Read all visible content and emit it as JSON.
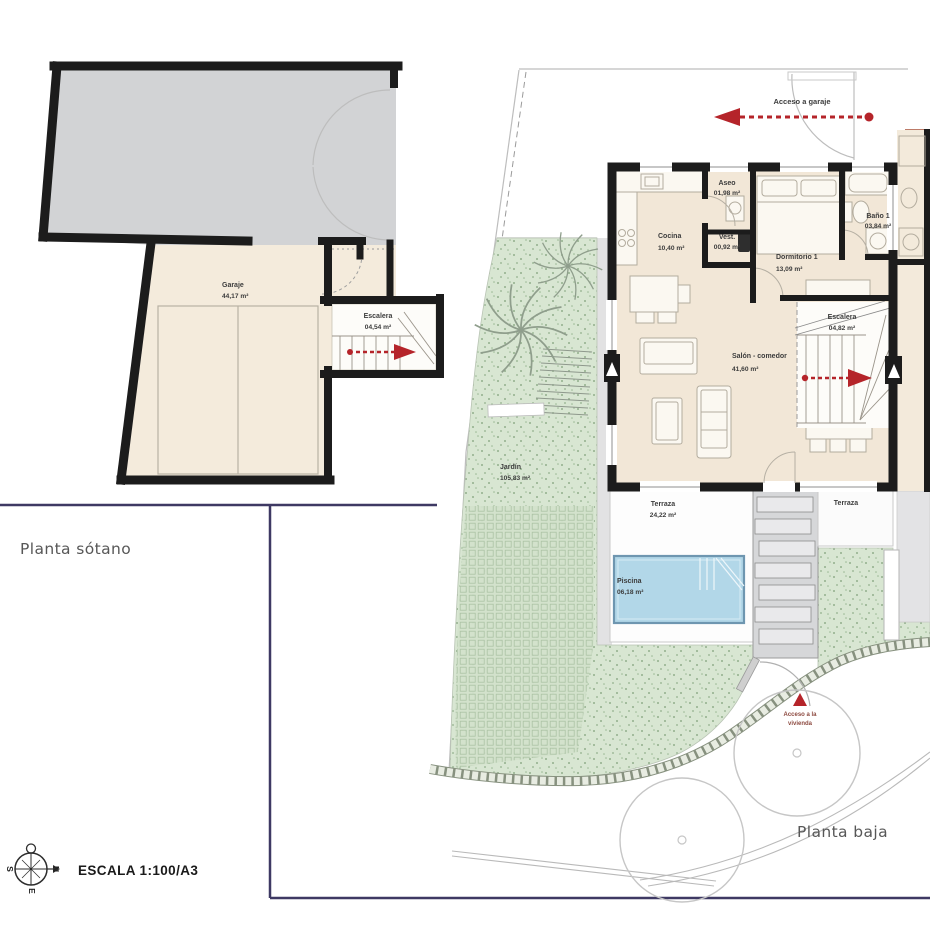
{
  "titles": {
    "basement": "Planta sótano",
    "ground": "Planta baja",
    "scale": "ESCALA 1:100/A3"
  },
  "compass": {
    "north": "N",
    "south": "S",
    "east": "E"
  },
  "basement_rooms": {
    "garaje": {
      "name": "Garaje",
      "area": "44,17 m²"
    },
    "escalera": {
      "name": "Escalera",
      "area": "04,54 m²"
    }
  },
  "ground_rooms": {
    "cocina": {
      "name": "Cocina",
      "area": "10,40 m²"
    },
    "aseo": {
      "name": "Aseo",
      "area": "01,98 m²"
    },
    "vest": {
      "name": "Vest.",
      "area": "00,92 m²"
    },
    "dormitorio1": {
      "name": "Dormitorio 1",
      "area": "13,09 m²"
    },
    "bano1": {
      "name": "Baño 1",
      "area": "03,84 m²"
    },
    "escalera": {
      "name": "Escalera",
      "area": "04,82 m²"
    },
    "salon": {
      "name": "Salón - comedor",
      "area": "41,60 m²"
    },
    "terraza_izquierda": {
      "name": "Terraza",
      "area": "24,22 m²"
    },
    "terraza_derecha": {
      "name": "Terraza"
    },
    "piscina": {
      "name": "Piscina",
      "area": "06,18 m²"
    },
    "jardin": {
      "name": "Jardín",
      "area": "105,83 m²"
    }
  },
  "annotations": {
    "acceso_garaje": "Acceso a garaje",
    "acceso_vivienda_line1": "Acceso a la",
    "acceso_vivienda_line2": "vivienda"
  },
  "colors": {
    "wall": "#1c1c1c",
    "floor_beige": "#f2e7d7",
    "driveway_gray": "#d2d3d5",
    "garden_green": "#d8e6d2",
    "pool_blue": "#b2d7e8",
    "accent_red": "#b5242a",
    "frame_navy": "#3e3963",
    "terracotta": "#bd7b68"
  }
}
